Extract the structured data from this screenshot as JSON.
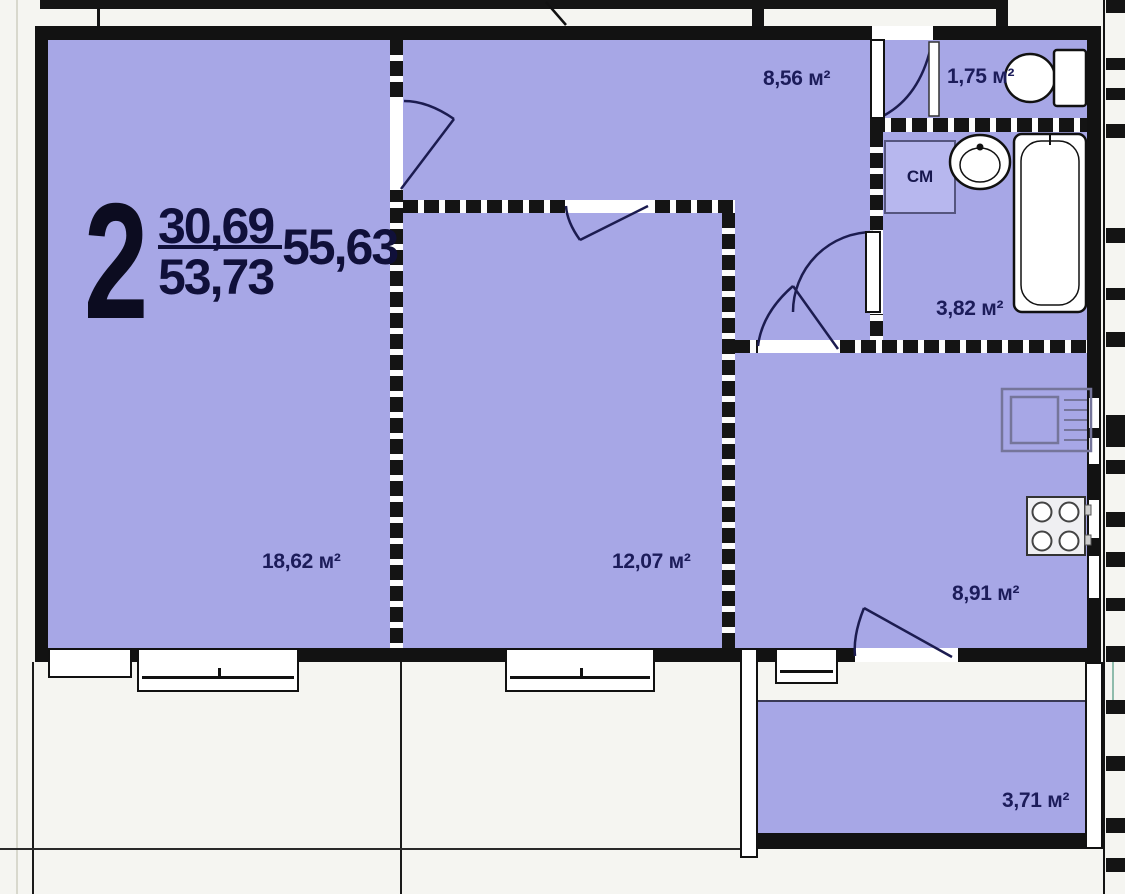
{
  "plan": {
    "unit_number": "2",
    "area_living": "30,69",
    "area_main": "53,73",
    "area_total": "55,63"
  },
  "rooms": [
    {
      "name": "living-room",
      "area_label": "18,62 м²"
    },
    {
      "name": "bedroom",
      "area_label": "12,07 м²"
    },
    {
      "name": "hallway",
      "area_label": "8,56 м²"
    },
    {
      "name": "wc",
      "area_label": "1,75 м²"
    },
    {
      "name": "bathroom",
      "area_label": "3,82 м²"
    },
    {
      "name": "kitchen",
      "area_label": "8,91 м²"
    },
    {
      "name": "balcony",
      "area_label": "3,71 м²"
    }
  ],
  "fixtures": {
    "washing_machine_label": "СМ",
    "icons": [
      "toilet-icon",
      "wash-basin-icon",
      "bathtub-icon",
      "kitchen-sink-icon",
      "stove-icon"
    ]
  },
  "colors": {
    "room_fill": "#a7a7e6",
    "wall": "#121212",
    "label_text": "#1c1c5a",
    "door_line": "#1c1c50",
    "background": "#f5f5f1"
  }
}
